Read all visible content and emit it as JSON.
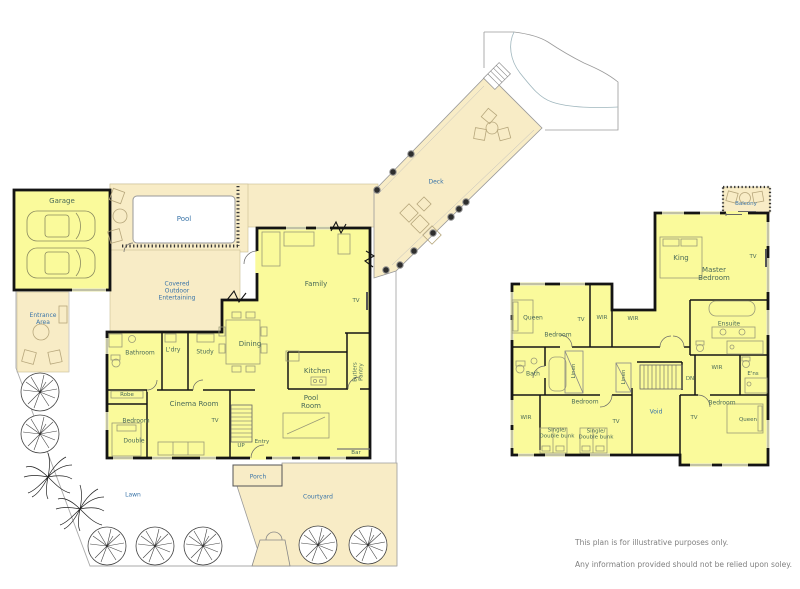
{
  "colors": {
    "room_fill": "#FAFA9B",
    "outdoor_fill": "#F8ECC6",
    "wall": "#141414",
    "pool_fill": "#FFFFFF",
    "room_label": "#4A6A58",
    "outdoor_label": "#3A74A8",
    "disclaimer_text": "#808080"
  },
  "site": {
    "pool": "Pool",
    "deck": "Deck",
    "lawn": "Lawn",
    "courtyard": "Courtyard",
    "porch": "Porch",
    "entrance": "Entrance\nArea",
    "covered": "Covered\nOutdoor\nEntertaining",
    "balcony": "Balcony",
    "void": "Void"
  },
  "ground": {
    "garage": "Garage",
    "family": "Family",
    "tv_family": "TV",
    "dining": "Dining",
    "kitchen": "Kitchen",
    "butlers_pantry": "Butlers\nPantry",
    "bathroom": "Bathroom",
    "laundry": "L'dry",
    "study": "Study",
    "robe": "Robe",
    "bedroom": "Bedroom",
    "bed_double": "Double",
    "cinema": "Cinema Room",
    "tv_cinema": "TV",
    "up": "UP",
    "entry": "Entry",
    "pool_room": "Pool\nRoom",
    "bar": "Bar"
  },
  "upper": {
    "king": "King",
    "master": "Master\nBedroom",
    "tv_master": "TV",
    "queen_front": "Queen",
    "bedroom_front": "Bedroom",
    "tv_front": "TV",
    "wir_1": "WIR",
    "wir_2": "WIR",
    "ensuite": "Ensuite",
    "bath": "Bath",
    "linen_1": "Linen",
    "linen_2": "Linen",
    "dn": "DN",
    "wir_3": "WIR",
    "ens": "E'ns",
    "bedroom_bunk": "Bedroom",
    "wir_4": "WIR",
    "tv_bunk": "TV",
    "bunk_1": "Single/\nDouble bunk",
    "bunk_2": "Single/\nDouble bunk",
    "bedroom_rear": "Bedroom",
    "tv_rear": "TV",
    "queen_rear": "Queen"
  },
  "disclaimer": {
    "line_1": "This plan is for illustrative purposes only.",
    "line_2": "Any information provided should not be relied upon soley."
  }
}
